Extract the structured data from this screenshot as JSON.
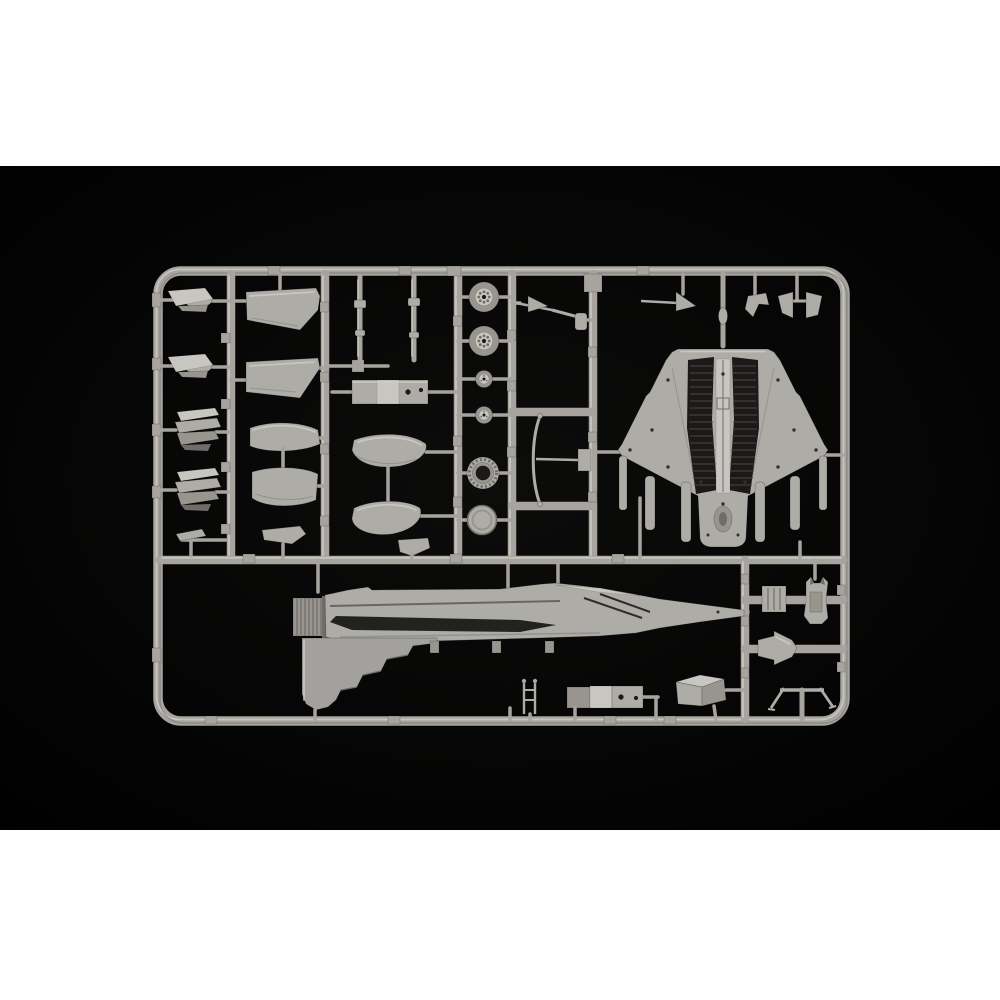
{
  "scene": {
    "domain": "natural-image",
    "subject": "Injection-molded plastic model kit sprue of a delta-wing jet fighter",
    "alt": "Light grey plastic model-kit sprue photographed on a black studio background. The rectangular runner frame holds a delta-wing lower fuselage, a fuselage side half with tail fin and exhaust nozzle, wheels, a turbine ring, landing-gear struts, wing panels, canards, an ejection seat and many small parts. White bands fill the top and bottom of the square image.",
    "backdrop": "black",
    "letterbox_bands": "white",
    "text_visible": ""
  },
  "photo": {
    "top_px": 166,
    "height_px": 664,
    "width_px": 1000
  },
  "colors": {
    "pageBg": "#ffffff",
    "photoBg": "#040404",
    "photoBgCenter": "#0c0c0b",
    "rail": "#a7a49f",
    "railLight": "#cfccc6",
    "railDark": "#74726e",
    "part": "#aeaca7",
    "partLight": "#c8c6c1",
    "partMid": "#98958f",
    "partDark": "#6f6d69",
    "recess": "#1b1a18",
    "rib": "#4c4a47"
  },
  "parts_inventory": [
    {
      "id": "sprue-frame",
      "label": "rectangular runner frame with internal rails"
    },
    {
      "id": "part-lower-fuselage",
      "label": "lower fuselage with delta wings, twin engine bays (top-down)"
    },
    {
      "id": "part-fuselage-half",
      "label": "fuselage side half with vertical fin and exhaust nozzle"
    },
    {
      "id": "part-canard-a",
      "label": "canard foreplane (left)"
    },
    {
      "id": "part-canard-b",
      "label": "canard foreplane (right)"
    },
    {
      "id": "part-fin-petals-a",
      "label": "stacked fin / petal part A"
    },
    {
      "id": "part-fin-petals-b",
      "label": "stacked fin / petal part B"
    },
    {
      "id": "part-small-bracket-left",
      "label": "small bracket"
    },
    {
      "id": "part-wing-panel-a",
      "label": "wing panel A"
    },
    {
      "id": "part-wing-panel-b",
      "label": "wing panel B"
    },
    {
      "id": "part-duct-half-a",
      "label": "curved duct half A"
    },
    {
      "id": "part-duct-half-b",
      "label": "curved duct half B"
    },
    {
      "id": "part-small-bracket-2",
      "label": "small bracket"
    },
    {
      "id": "part-strut-a",
      "label": "slender strut / door edge A"
    },
    {
      "id": "part-strut-b",
      "label": "slender strut / door edge B"
    },
    {
      "id": "part-equipment-box",
      "label": "equipment box with two holes"
    },
    {
      "id": "part-intake-lip-a",
      "label": "curved intake lip A"
    },
    {
      "id": "part-intake-lip-b",
      "label": "curved intake lip B"
    },
    {
      "id": "part-wheel-large-a",
      "label": "main wheel (spoked hub) A"
    },
    {
      "id": "part-wheel-large-b",
      "label": "main wheel (spoked hub) B"
    },
    {
      "id": "part-wheel-small-a",
      "label": "nose wheel A"
    },
    {
      "id": "part-wheel-small-b",
      "label": "nose wheel B"
    },
    {
      "id": "part-turbine-ring",
      "label": "ribbed turbine / afterburner ring"
    },
    {
      "id": "part-hub-disc",
      "label": "smooth hub disc"
    },
    {
      "id": "part-gear-leg-a",
      "label": "landing-gear leg with brace"
    },
    {
      "id": "part-gear-leg-b",
      "label": "long curved gear strut"
    },
    {
      "id": "part-pitot-probe",
      "label": "pitot probe with vane"
    },
    {
      "id": "part-hook",
      "label": "small hook fitting"
    },
    {
      "id": "part-twin-bracket",
      "label": "twin wedge brackets"
    },
    {
      "id": "part-boarding-ladder",
      "label": "boarding ladder"
    },
    {
      "id": "part-equipment-box-2",
      "label": "segmented equipment box with holes"
    },
    {
      "id": "part-equipment-box-3",
      "label": "rectangular box (3-quarter view)"
    },
    {
      "id": "part-access-panel",
      "label": "square ribbed access panel"
    },
    {
      "id": "part-ejection-seat",
      "label": "ejection seat"
    },
    {
      "id": "part-arrow-fairing",
      "label": "arrow-shaped fairing"
    },
    {
      "id": "part-trestle",
      "label": "trestle / linkage with splayed legs"
    }
  ]
}
